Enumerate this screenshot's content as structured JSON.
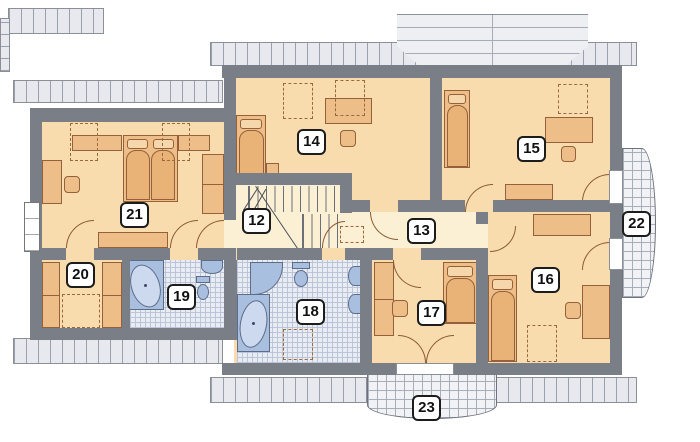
{
  "rooms": [
    {
      "id": 12,
      "label": "12"
    },
    {
      "id": 13,
      "label": "13"
    },
    {
      "id": 14,
      "label": "14"
    },
    {
      "id": 15,
      "label": "15"
    },
    {
      "id": 16,
      "label": "16"
    },
    {
      "id": 17,
      "label": "17"
    },
    {
      "id": 18,
      "label": "18"
    },
    {
      "id": 19,
      "label": "19"
    },
    {
      "id": 20,
      "label": "20"
    },
    {
      "id": 21,
      "label": "21"
    },
    {
      "id": 22,
      "label": "22"
    },
    {
      "id": 23,
      "label": "23"
    }
  ],
  "palette": {
    "wall": "#797e87",
    "room_floor": "#f8dcae",
    "hall_floor": "#fcf0d4",
    "furniture": "#eebe88",
    "sanitary": "#a9bfe0",
    "tile_floor": "#e9ecf3",
    "eave": "#e7e9ee"
  }
}
